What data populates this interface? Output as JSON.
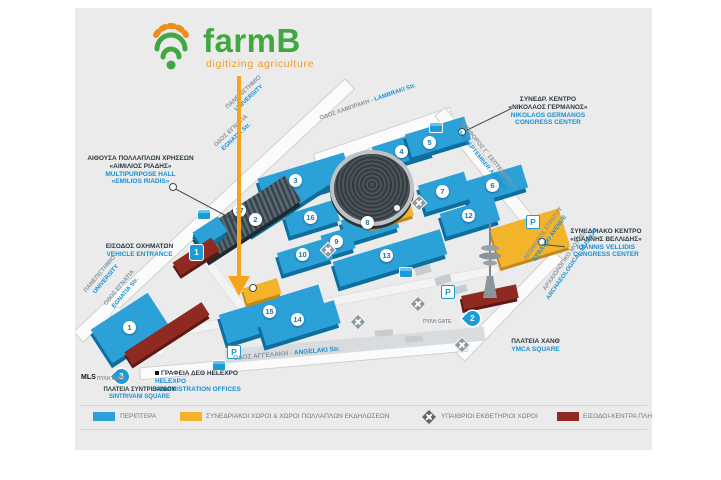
{
  "logo": {
    "title": "farmB",
    "subtitle": "digitizing agriculture"
  },
  "map": {
    "pavilions": {
      "p1": "1",
      "p2": "2",
      "p3": "3",
      "p4": "4",
      "p5": "5",
      "p6": "6",
      "p7": "7",
      "p8": "8",
      "p9": "9",
      "p10": "10",
      "p12": "12",
      "p13": "13",
      "p14": "14",
      "p15": "15",
      "p16": "16",
      "p17": "17"
    },
    "gates": {
      "word": "ΠΥΛΗ GATE",
      "mls": "MLS",
      "g1": "1",
      "g2": "2",
      "g3": "3"
    },
    "parking": "P",
    "landmarks": {
      "multipurpose": {
        "gr1": "ΑΙΘΟΥΣΑ ΠΟΛΛΑΠΛΩΝ ΧΡΗΣΕΩΝ",
        "gr2": "«ΑΙΜΙΛΙΟΣ ΡΙΑΔΗΣ»",
        "en1": "MULTIPURPOSE HALL",
        "en2": "«EMILIOS RIADIS»"
      },
      "germanos": {
        "gr1": "ΣΥΝΕΔΡ. ΚΕΝΤΡΟ",
        "gr2": "«ΝΙΚΟΛΑΟΣ ΓΕΡΜΑΝΟΣ»",
        "en1": "NIKOLAOS GERMANOS",
        "en2": "CONGRESS CENTER"
      },
      "vellidis": {
        "gr1": "ΣΥΝΕΔΡΙΑΚΟ ΚΕΝΤΡΟ",
        "gr2": "«ΙΩΑΝΝΗΣ ΒΕΛΛΙΔΗΣ»",
        "en1": "IOANNIS VELLIDIS",
        "en2": "CONGRESS CENTER"
      },
      "vehicle_entrance": {
        "gr": "ΕΙΣΟΔΟΣ ΟΧΗΜΑΤΩΝ",
        "en": "VEHICLE ENTRANCE"
      },
      "helexpo": {
        "gr": "ΓΡΑΦΕΙΑ ΔΕΘ HELEXPO",
        "en1": "HELEXPO",
        "en2": "ADMINISTRATION OFFICES"
      },
      "sintrivani": {
        "gr": "ΠΛΑΤΕΙΑ ΣΥΝΤΡΙΒΑΝΙΟΥ",
        "en": "SINTRIVANI SQUARE"
      },
      "ymca": {
        "gr": "ΠΛΑΤΕΙΑ ΧΑΝΘ",
        "en": "YMCA SQUARE"
      }
    },
    "streets": {
      "university": {
        "gr": "ΠΑΝΕΠΙΣΤΗΜΙΟ",
        "en": "UNIVERSITY"
      },
      "egnatia": {
        "gr": "ΟΔΟΣ ΕΓΝΑΤΙΑ",
        "en": "EGNATIA Str."
      },
      "lambraki": {
        "gr": "ΟΔΟΣ ΛΑΜΠΡΑΚΗ -",
        "en": "LAMBRAKI Str."
      },
      "september": {
        "gr": "ΛΕΩΦΟΡΟΣ Γ΄ ΣΕΠΤΕΜΒΡΙΟΥ",
        "en": "3rd SEPTEMBER AVENUE"
      },
      "stratou": {
        "gr": "ΛΕΩΦΟΡΟΣ ΣΤΡΑΤΟΥ",
        "en": "STRATOU AVENUE"
      },
      "museum": {
        "gr": "ΑΡΧΑΙΟΛΟΓΙΚΟ ΜΟΥΣΕΙΟ",
        "en": "ARCHAEOLOGICAL MUSEUM"
      },
      "angelaki": {
        "gr": "ΟΔΟΣ ΑΓΓΕΛΑΚΗ -",
        "en": "ANGELAKI Str."
      }
    }
  },
  "legend": {
    "items": [
      {
        "label": "ΠΕΡΙΠΤΕΡΑ"
      },
      {
        "label": "ΣΥΝΕΔΡΙΑΚΟΙ ΧΩΡΟΙ & ΧΩΡΟΙ ΠΟΛΛΑΠΛΩΝ ΕΚΔΗΛΩΣΕΩΝ"
      },
      {
        "label": "ΥΠΑΙΘΡΙΟΙ ΕΚΘΕΤΗΡΙΟΙ ΧΩΡΟΙ"
      },
      {
        "label": "ΕΙΣΟΔΟΙ-ΚΕΝΤΡΑ ΠΛΗΡΟΦΟΡΙΩΝ"
      }
    ]
  },
  "colors": {
    "pavilion_blue": "#2ba1d8",
    "conference_yellow": "#f3b32b",
    "entrance_maroon": "#8e2a21",
    "accent_blue": "#1b8ed2",
    "logo_green": "#3fa83f",
    "logo_orange": "#f59b1b"
  }
}
